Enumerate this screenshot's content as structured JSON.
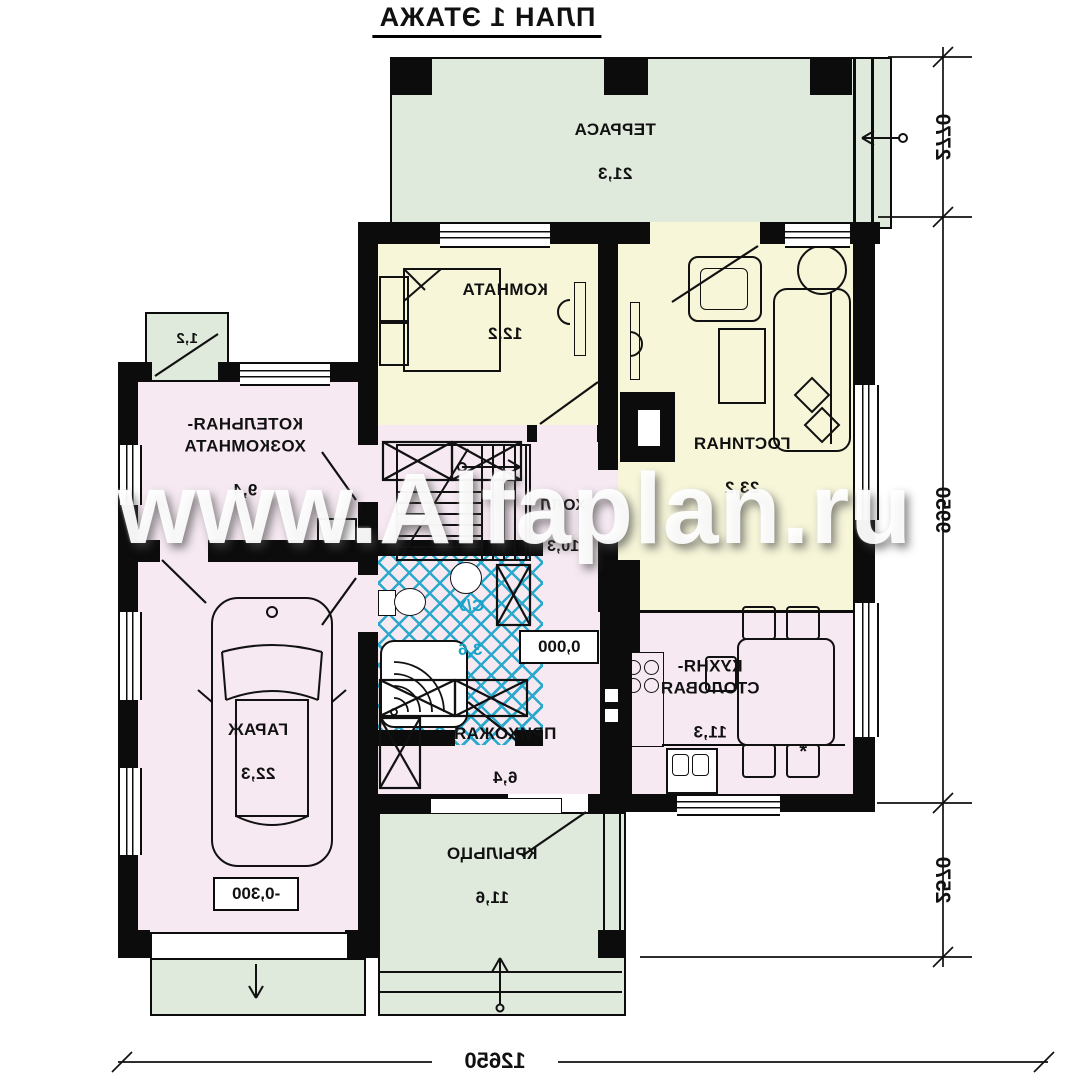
{
  "plan": {
    "title": "ПЛАН 1 ЭТАЖА"
  },
  "watermark": {
    "text": "www.Alfaplan.ru"
  },
  "rooms": [
    {
      "name": "ТЕРРАСА",
      "area": "21,3"
    },
    {
      "name": "КОМНАТА",
      "area": "12,2"
    },
    {
      "name": "ГОСТИНАЯ",
      "area": "23,2"
    },
    {
      "name": "КОТЕЛЬНАЯ-\nХОЗКОМНАТА",
      "area": "9,4"
    },
    {
      "name": "ГАРАЖ",
      "area": "22,3"
    },
    {
      "name": "ХОЛЛ",
      "area": "10,3"
    },
    {
      "name": "С/У",
      "area": "3,6"
    },
    {
      "name": "ПРИХОЖАЯ",
      "area": "6,4"
    },
    {
      "name": "КУХНЯ-\nСТОЛОВАЯ",
      "area": "11,3"
    },
    {
      "name": "КРЫЛЬЦО",
      "area": "11,6"
    }
  ],
  "annex": {
    "area": "1,2"
  },
  "levels": {
    "main": "0,000",
    "garage": "-0,300"
  },
  "dimensions": {
    "right": [
      "2770",
      "9950",
      "2570"
    ],
    "bottom": [
      "12650"
    ]
  },
  "marks": {
    "star": "*"
  }
}
